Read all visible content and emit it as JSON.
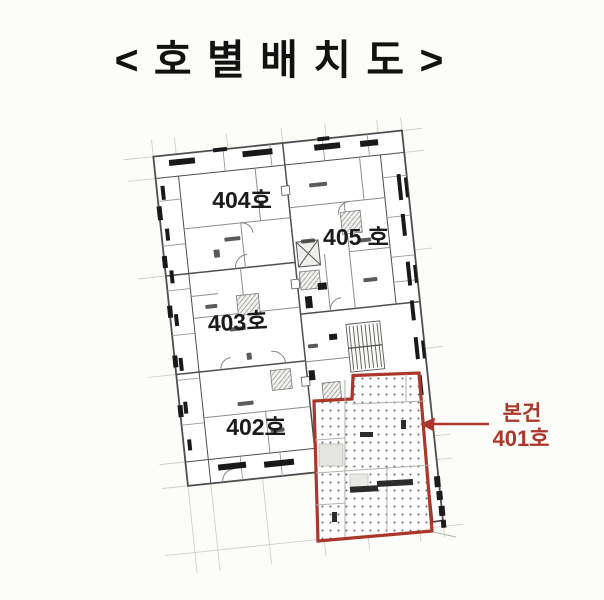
{
  "title": "< 호 별 배 치 도 >",
  "plan": {
    "units": [
      {
        "id": "404",
        "label": "404호"
      },
      {
        "id": "405",
        "label": "405 호"
      },
      {
        "id": "403",
        "label": "403호"
      },
      {
        "id": "402",
        "label": "402호"
      }
    ],
    "subject": {
      "line1": "본건",
      "line2": "401호"
    },
    "colors": {
      "highlight": "#ab372c",
      "plan_line_dark": "#4e4e4e",
      "plan_line_light": "#8c8c8c",
      "grid": "#cbcbc5",
      "ink_marks": "#191919",
      "background": "#fcfcf9",
      "label_text": "#1b1b1b"
    }
  }
}
